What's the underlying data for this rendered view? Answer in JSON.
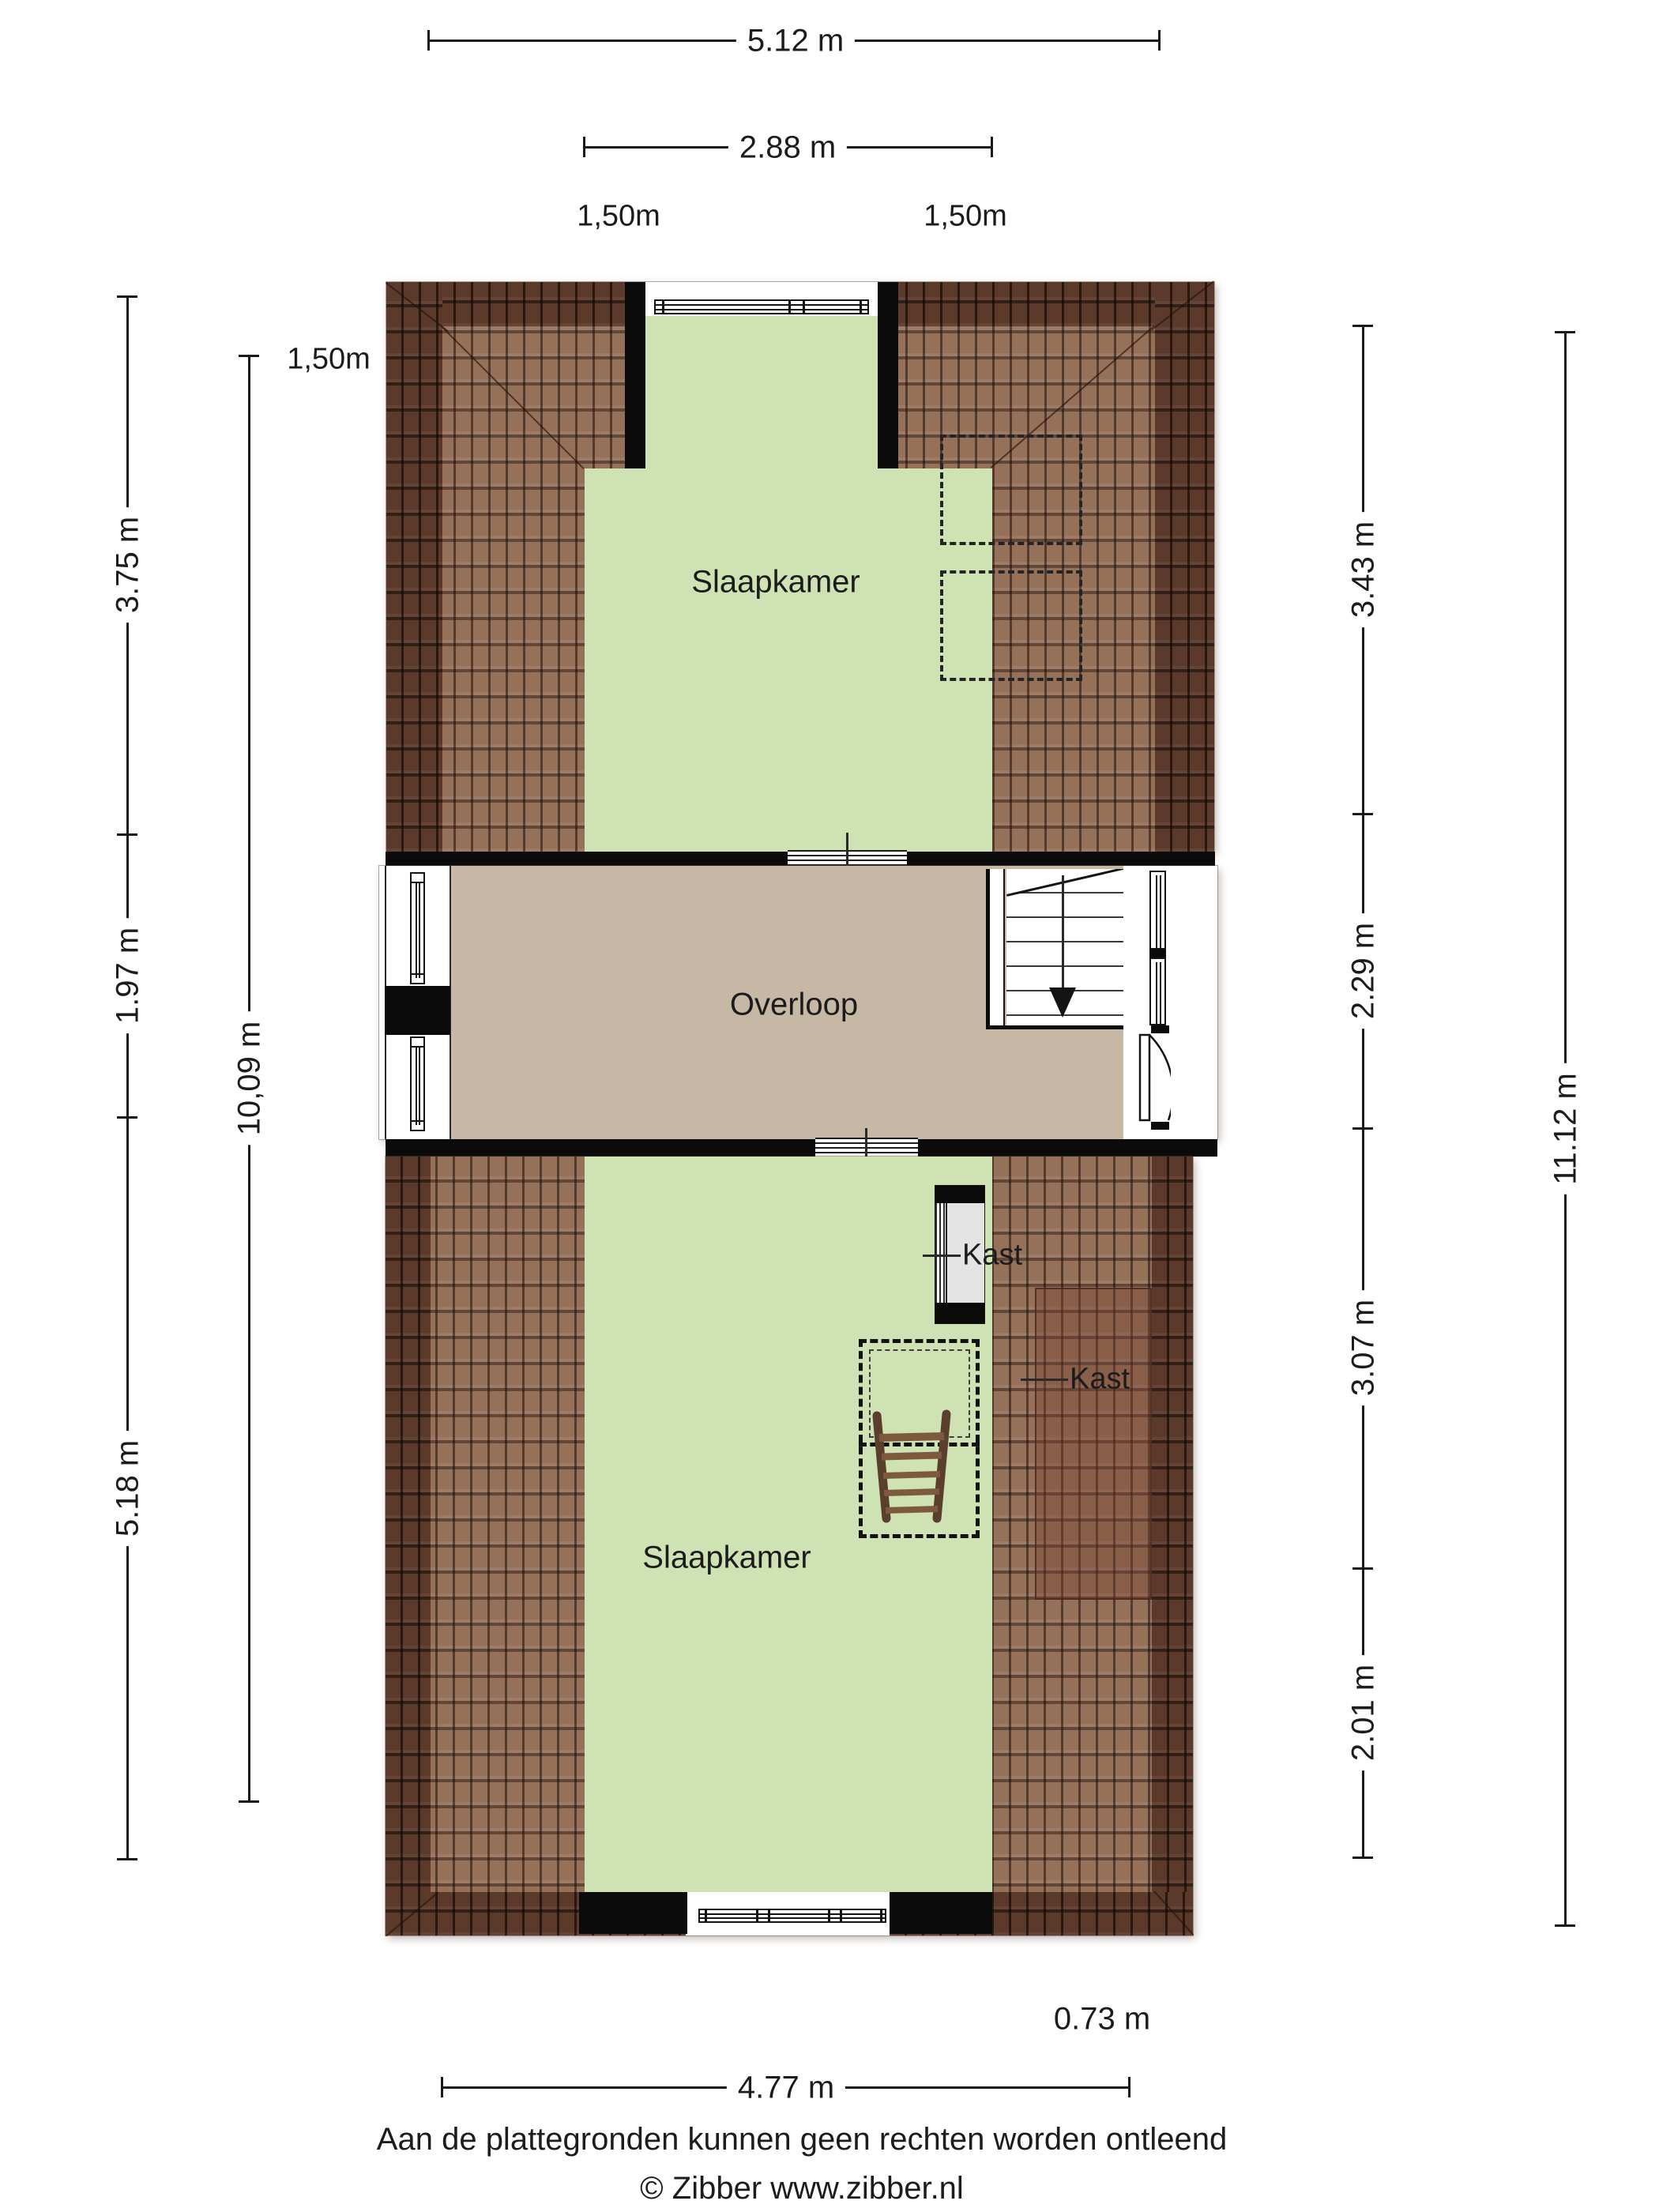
{
  "dims": {
    "top_outer": "5.12 m",
    "top_inner": "2.88 m",
    "contour_top_left": "1,50m",
    "contour_top_right": "1,50m",
    "contour_left": "1,50m",
    "left_segments": [
      "3.75 m",
      "1.97 m",
      "5.18 m"
    ],
    "left_contour_length": "10,09 m",
    "right_segments": [
      "3.43 m",
      "2.29 m",
      "3.07 m",
      "2.01 m"
    ],
    "right_outer": "11.12 m",
    "bottom_width": "4.77 m",
    "closet_depth": "0.73 m"
  },
  "rooms": {
    "bedroom_top": "Slaapkamer",
    "landing": "Overloop",
    "bedroom_bottom": "Slaapkamer",
    "closet_inner": "Kast",
    "closet_roof": "Kast"
  },
  "footer": {
    "disclaimer": "Aan de plattegronden kunnen geen rechten worden ontleend",
    "copyright": "© Zibber www.zibber.nl"
  },
  "colors": {
    "room_green": "#cfe2b3",
    "landing_tan": "#c7b8a5",
    "roof_light": "#96715a",
    "roof_dark": "#5b3a2b",
    "wall_black": "#0b0b0b",
    "closet_grey": "#e3e3e3"
  }
}
